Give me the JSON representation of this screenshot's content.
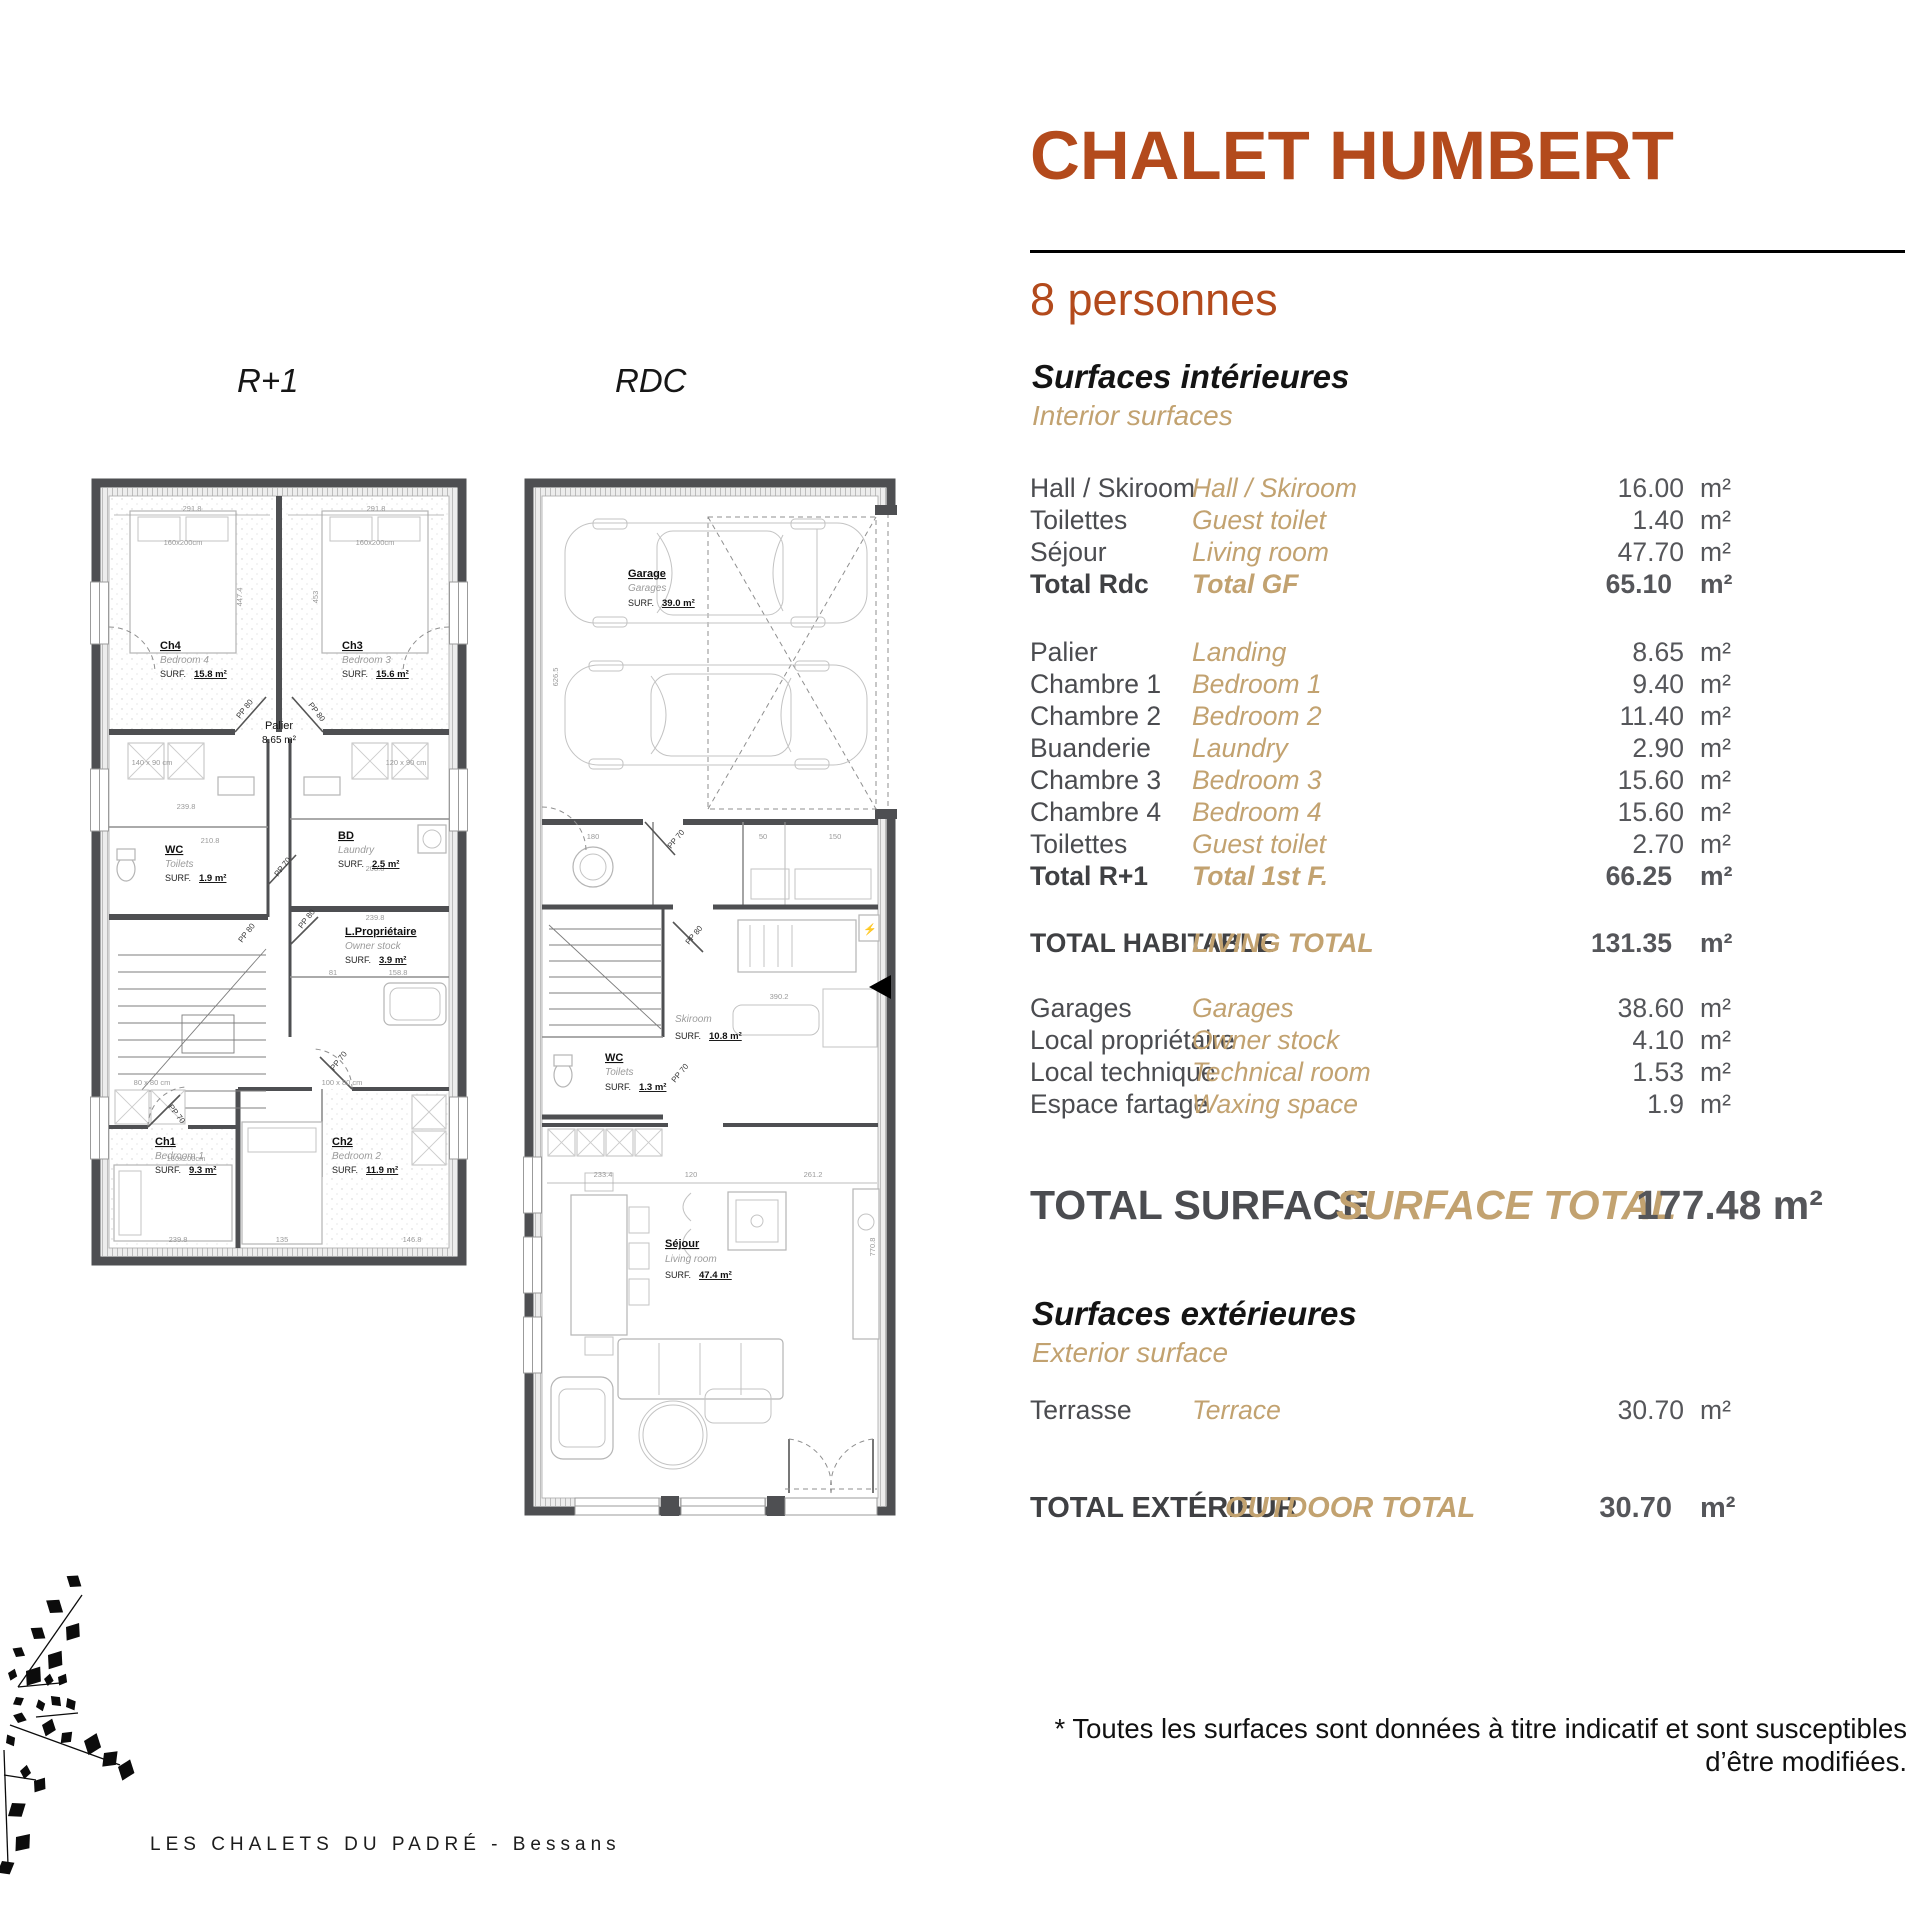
{
  "page": {
    "title": "CHALET HUMBERT",
    "capacity": "8 personnes",
    "footer": "LES CHALETS DU PADRÉ - Bessans",
    "disclaimer_line1": "* Toutes les surfaces sont données à titre indicatif et sont susceptibles",
    "disclaimer_line2": "d’être modifiées."
  },
  "interior": {
    "title_fr": "Surfaces intérieures",
    "title_en": "Interior surfaces",
    "unit": "m²",
    "rdc_rows": [
      {
        "fr": "Hall / Skiroom",
        "en": "Hall / Skiroom",
        "val": "16.00"
      },
      {
        "fr": "Toilettes",
        "en": "Guest toilet",
        "val": "1.40"
      },
      {
        "fr": "Séjour",
        "en": "Living room",
        "val": "47.70"
      },
      {
        "fr": "Total Rdc",
        "en": "Total GF",
        "val": "65.10"
      }
    ],
    "r1_rows": [
      {
        "fr": "Palier",
        "en": "Landing",
        "val": "8.65"
      },
      {
        "fr": "Chambre 1",
        "en": "Bedroom 1",
        "val": "9.40"
      },
      {
        "fr": "Chambre 2",
        "en": "Bedroom 2",
        "val": "11.40"
      },
      {
        "fr": "Buanderie",
        "en": "Laundry",
        "val": "2.90"
      },
      {
        "fr": "Chambre 3",
        "en": "Bedroom 3",
        "val": "15.60"
      },
      {
        "fr": "Chambre 4",
        "en": "Bedroom 4",
        "val": "15.60"
      },
      {
        "fr": "Toilettes",
        "en": "Guest toilet",
        "val": "2.70"
      },
      {
        "fr": "Total R+1",
        "en": "Total 1st F.",
        "val": "66.25"
      }
    ],
    "living_total": {
      "fr": "TOTAL HABITABLE",
      "en": "LIVING TOTAL",
      "val": "131.35"
    },
    "annex_rows": [
      {
        "fr": "Garages",
        "en": "Garages",
        "val": "38.60"
      },
      {
        "fr": "Local propriétaire",
        "en": "Owner stock",
        "val": "4.10"
      },
      {
        "fr": "Local technique",
        "en": "Technical room",
        "val": "1.53"
      },
      {
        "fr": "Espace fartage",
        "en": "Waxing space",
        "val": "1.9"
      }
    ],
    "surface_total": {
      "fr": "TOTAL SURFACE",
      "en": "SURFACE TOTAL",
      "val": "177.48 m²"
    }
  },
  "exterior": {
    "title_fr": "Surfaces extérieures",
    "title_en": "Exterior surface",
    "rows": [
      {
        "fr": "Terrasse",
        "en": "Terrace",
        "val": "30.70"
      }
    ],
    "total": {
      "fr": "TOTAL EXTÉRIEUR",
      "en": "OUTDOOR TOTAL",
      "val": "30.70"
    }
  },
  "plans": {
    "r1": {
      "label": "R+1",
      "surf_label": "SURF.",
      "rooms": {
        "ch4": {
          "code": "Ch4",
          "name": "Bedroom 4",
          "area": "15.8 m²"
        },
        "ch3": {
          "code": "Ch3",
          "name": "Bedroom 3",
          "area": "15.6 m²"
        },
        "palier": {
          "code": "Palier",
          "area": "8.65 m²"
        },
        "wc": {
          "code": "WC",
          "name": "Toilets",
          "area": "1.9 m²"
        },
        "bd": {
          "code": "BD",
          "name": "Laundry",
          "area": "2.5 m²"
        },
        "lp": {
          "code": "L.Propriétaire",
          "name": "Owner stock",
          "area": "3.9 m²"
        },
        "ch1": {
          "code": "Ch1",
          "name": "Bedroom 1",
          "area": "9.3 m²"
        },
        "ch2": {
          "code": "Ch2",
          "name": "Bedroom 2",
          "area": "11.9 m²"
        }
      },
      "beds": [
        "160x200cm",
        "160x200cm",
        "160x200cm"
      ],
      "fixtures": [
        "140 x 90 cm",
        "120 x 90 cm",
        "80 x 80 cm",
        "100 x 80 cm"
      ],
      "dims": [
        "291.8",
        "291.8",
        "447.4",
        "453",
        "239.8",
        "210.8",
        "208.8",
        "239.8",
        "81",
        "158.8",
        "135",
        "146.8",
        "239.8"
      ],
      "doors": [
        "PP 80",
        "PP 80",
        "PP 70",
        "PP 80",
        "PP 80",
        "PP 70",
        "PP 70"
      ]
    },
    "rdc": {
      "label": "RDC",
      "surf_label": "SURF.",
      "rooms": {
        "garage": {
          "code": "Garage",
          "name": "Garages",
          "area": "39.0 m²"
        },
        "skiroom": {
          "name": "Skiroom",
          "area": "10.8 m²"
        },
        "wc": {
          "code": "WC",
          "name": "Toilets",
          "area": "1.3 m²"
        },
        "sejour": {
          "code": "Séjour",
          "name": "Living room",
          "area": "47.4 m²"
        }
      },
      "dims": [
        "626.5",
        "180",
        "50",
        "150",
        "390.2",
        "233.4",
        "120",
        "261.2",
        "770.8"
      ],
      "doors": [
        "PP 70",
        "PP 80",
        "PP 70"
      ]
    }
  }
}
